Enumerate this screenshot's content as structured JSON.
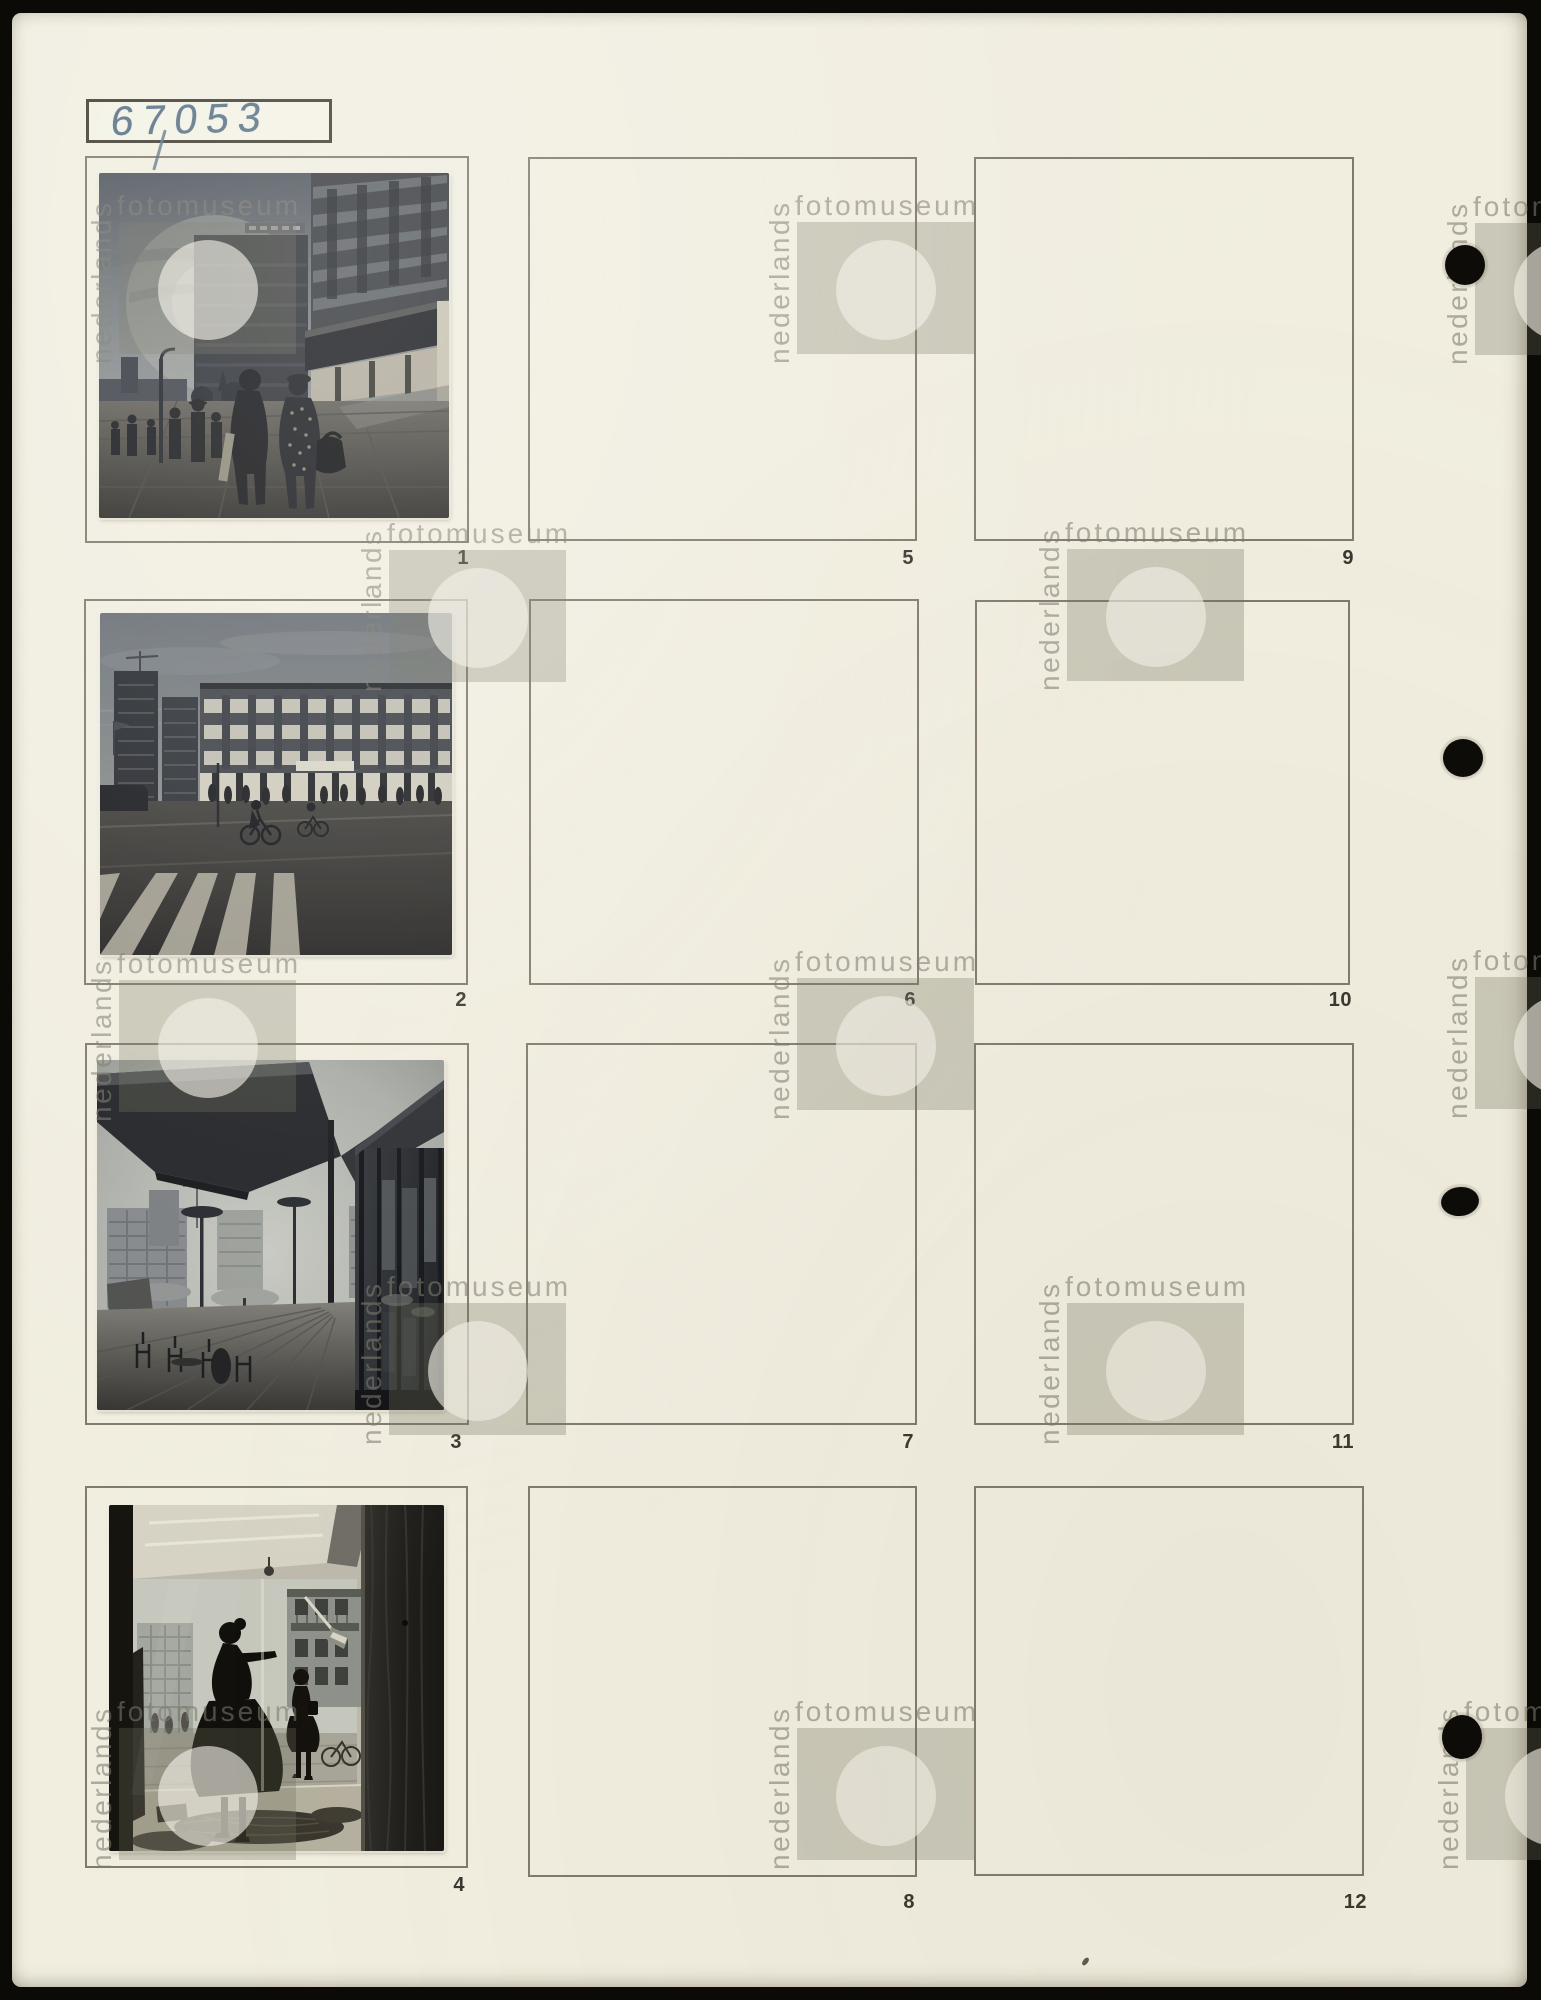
{
  "page": {
    "archive_label": "67053",
    "watermark": {
      "vertical_text": "nederlands",
      "horizontal_text": "fotomuseum"
    },
    "punch_hole_count": 4,
    "colors": {
      "paper": "#f1eee0",
      "scan_background": "#0b0a07",
      "handwriting_ink": "#567083",
      "frame_line": "#605a4c",
      "frame_number": "#3a372f",
      "watermark_gray": "#9b9a8a"
    }
  },
  "frames": [
    {
      "number": "1",
      "has_photo": true
    },
    {
      "number": "2",
      "has_photo": true
    },
    {
      "number": "3",
      "has_photo": true
    },
    {
      "number": "4",
      "has_photo": true
    },
    {
      "number": "5",
      "has_photo": false
    },
    {
      "number": "6",
      "has_photo": false
    },
    {
      "number": "7",
      "has_photo": false
    },
    {
      "number": "8",
      "has_photo": false
    },
    {
      "number": "9",
      "has_photo": false
    },
    {
      "number": "10",
      "has_photo": false
    },
    {
      "number": "11",
      "has_photo": false
    },
    {
      "number": "12",
      "has_photo": false
    }
  ],
  "photos": [
    {
      "frame_number": "1",
      "depicts": "Two women with handbags walking along a modern shopping street, apartment block with balconies on the right"
    },
    {
      "frame_number": "2",
      "depicts": "Wide street with zebra crossing, cyclists and a long modern shopping block with lit window bands"
    },
    {
      "frame_number": "3",
      "depicts": "Square with parasols and disc-topped lamp posts seen from under a dark angular canopy beside a glass facade"
    },
    {
      "frame_number": "4",
      "depicts": "Shop window with a mannequin in a full skirt, fabrics on the display floor and a woman passing outside"
    }
  ]
}
